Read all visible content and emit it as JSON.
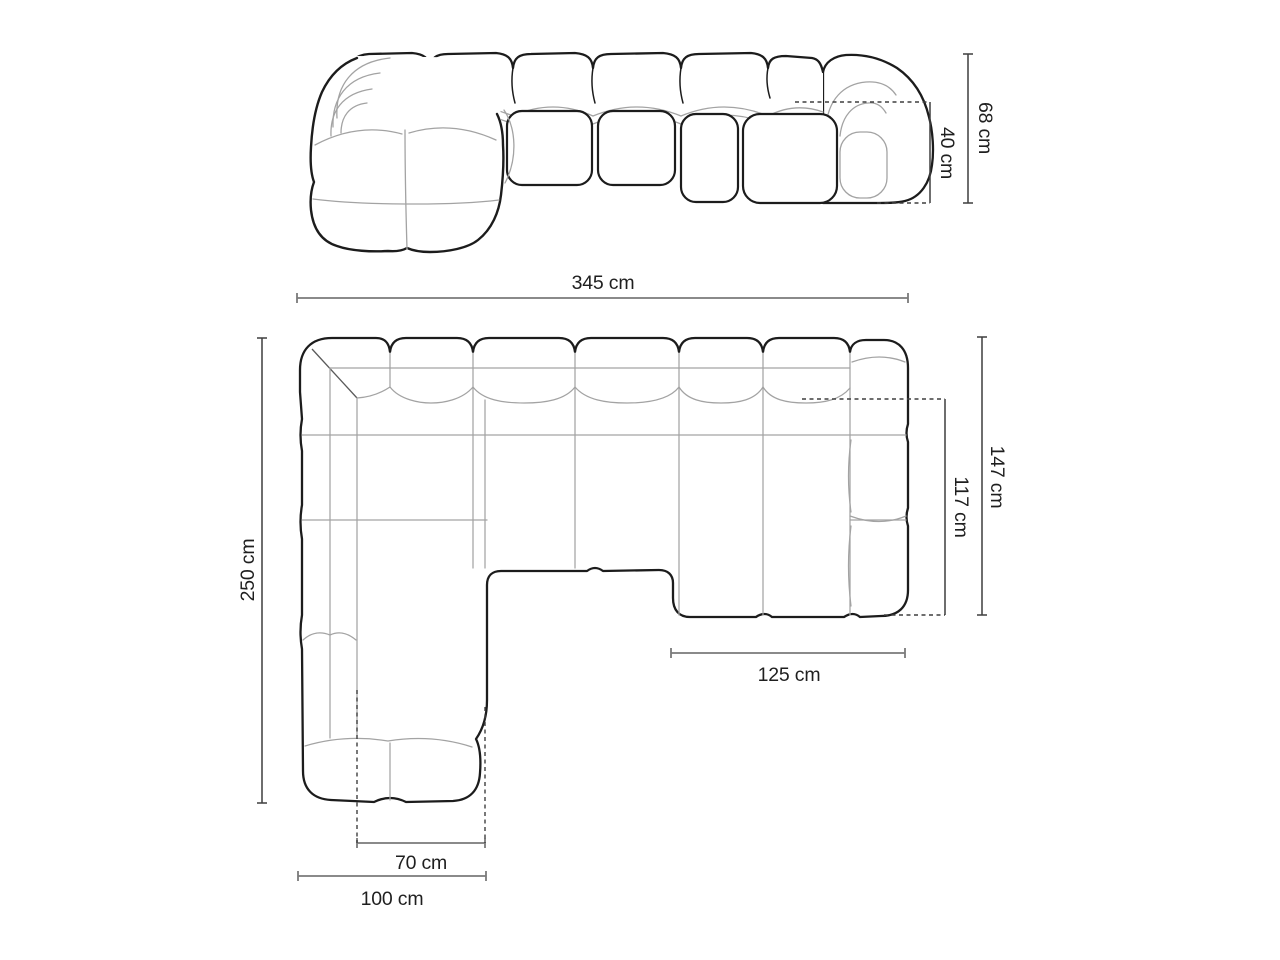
{
  "labels": {
    "total_width": "345 cm",
    "total_height": "68 cm",
    "seat_height": "40 cm",
    "total_depth": "250 cm",
    "right_side_depth": "147 cm",
    "right_chaise_depth": "117 cm",
    "right_chaise_width": "125 cm",
    "left_chaise_inner_width": "70 cm",
    "left_chaise_outer_width": "100 cm"
  },
  "colors": {
    "background": "#ffffff",
    "outline": "#1c1c1c",
    "seam": "#a3a3a3",
    "seam_dark": "#5a5a5a",
    "dimension_gray": "#7a7a7a",
    "dimension_dark": "#3f3f3f",
    "text": "#1f1f1f"
  }
}
